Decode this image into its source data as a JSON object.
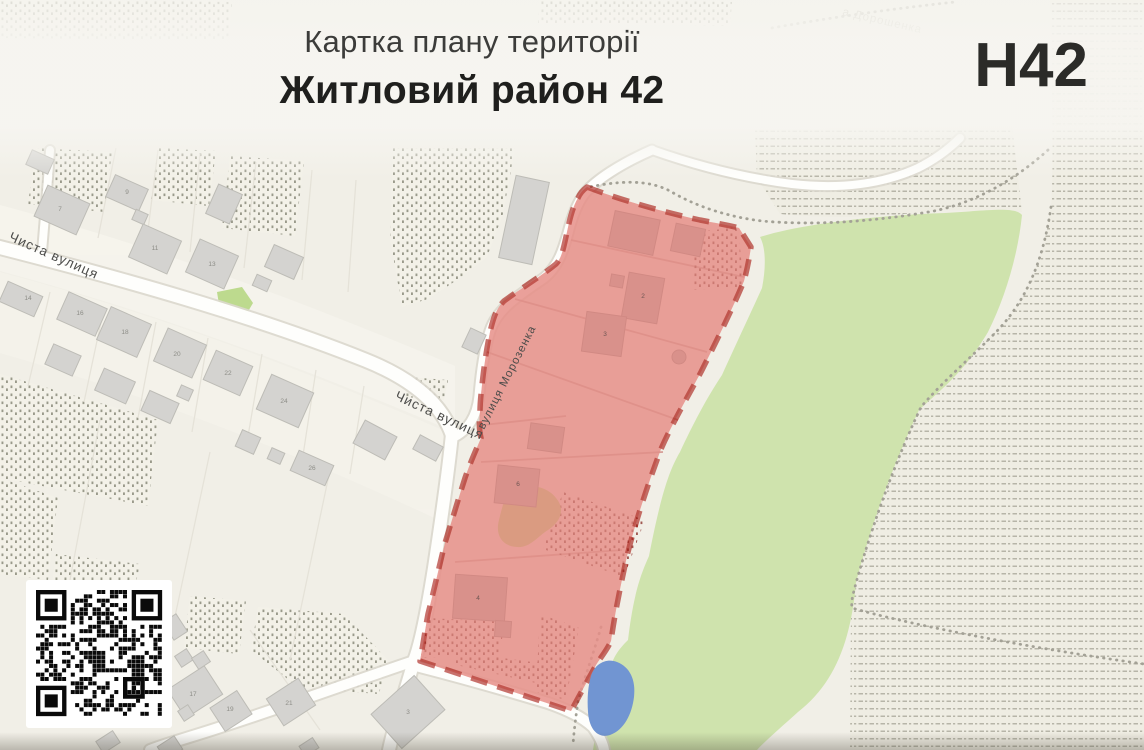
{
  "header": {
    "title_line1": "Картка плану території",
    "title_line2": "Житловий район 42",
    "code": "Н42"
  },
  "map": {
    "street_labels": {
      "chysta_left": "Чиста вулиця",
      "chysta_mid": "Чиста вулиця",
      "morozenka": "вулиця Морозенка",
      "doroshenka_partial": "а Дорошенка"
    },
    "house_numbers": [
      {
        "n": "7",
        "x": 60,
        "y": 211
      },
      {
        "n": "9",
        "x": 127,
        "y": 194
      },
      {
        "n": "11",
        "x": 155,
        "y": 250
      },
      {
        "n": "13",
        "x": 212,
        "y": 266
      },
      {
        "n": "14",
        "x": 28,
        "y": 300
      },
      {
        "n": "16",
        "x": 80,
        "y": 315
      },
      {
        "n": "18",
        "x": 125,
        "y": 334
      },
      {
        "n": "20",
        "x": 177,
        "y": 356
      },
      {
        "n": "22",
        "x": 228,
        "y": 375
      },
      {
        "n": "24",
        "x": 284,
        "y": 403
      },
      {
        "n": "26",
        "x": 312,
        "y": 470
      },
      {
        "n": "17",
        "x": 193,
        "y": 696
      },
      {
        "n": "19",
        "x": 230,
        "y": 711
      },
      {
        "n": "21",
        "x": 289,
        "y": 705
      },
      {
        "n": "3",
        "x": 408,
        "y": 714
      }
    ],
    "zone_numbers": [
      {
        "n": "2",
        "x": 643,
        "y": 298
      },
      {
        "n": "3",
        "x": 605,
        "y": 336
      },
      {
        "n": "4",
        "x": 478,
        "y": 600
      },
      {
        "n": "6",
        "x": 518,
        "y": 486
      }
    ],
    "colors": {
      "zone_fill": "#e78f88",
      "zone_border": "#a5150d",
      "field_green": "#cfe3ad",
      "water_blue": "#7195d2",
      "bare_ground": "#c7af77",
      "road": "#fefefc",
      "building_gray": "#d4d3d0",
      "building_zone": "#c69692",
      "map_base": "#f1efe7"
    }
  }
}
